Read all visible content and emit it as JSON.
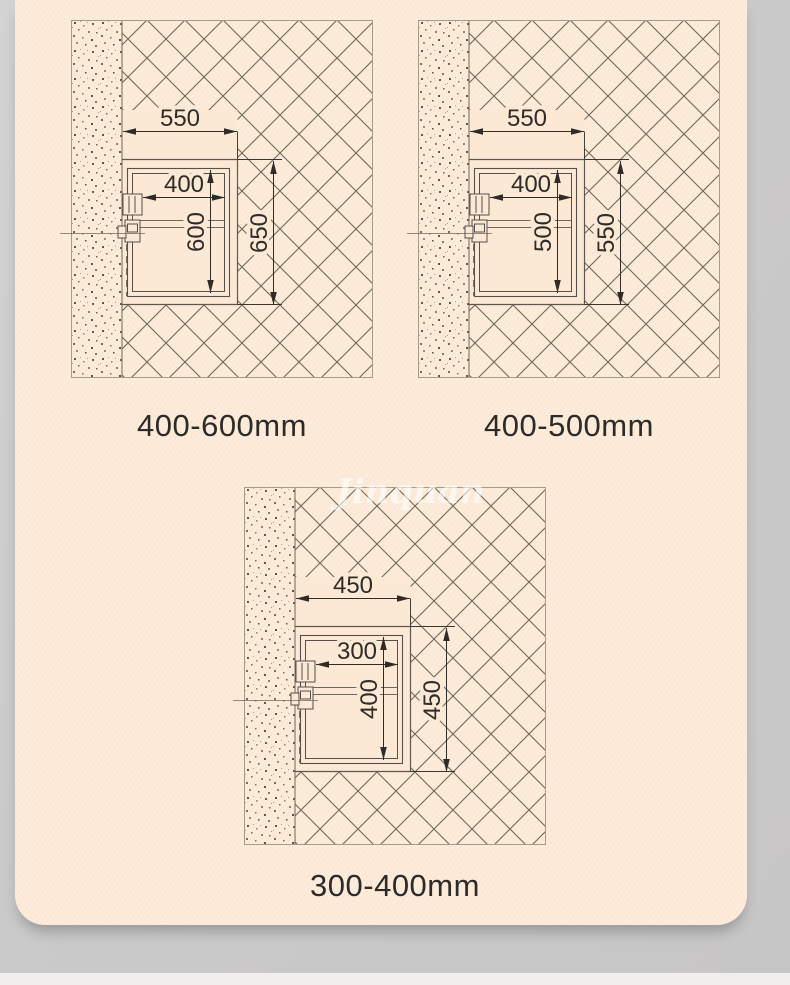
{
  "page": {
    "background_color": "#cbcaca",
    "card_color": "#fbe9d6",
    "drawing_line_color": "#6f6759",
    "dimension_color": "#2f2c27",
    "watermark_text": "Jinquan",
    "footer_strip_color": "#f1f0ee"
  },
  "diagrams": [
    {
      "name": "installation-drawing-400-600",
      "label": "400-600mm",
      "dims": {
        "top_width": "550",
        "inner_width": "400",
        "inner_height": "600",
        "outer_height": "650"
      }
    },
    {
      "name": "installation-drawing-400-500",
      "label": "400-500mm",
      "dims": {
        "top_width": "550",
        "inner_width": "400",
        "inner_height": "500",
        "outer_height": "550"
      }
    },
    {
      "name": "installation-drawing-300-400",
      "label": "300-400mm",
      "dims": {
        "top_width": "450",
        "inner_width": "300",
        "inner_height": "400",
        "outer_height": "450"
      }
    }
  ]
}
